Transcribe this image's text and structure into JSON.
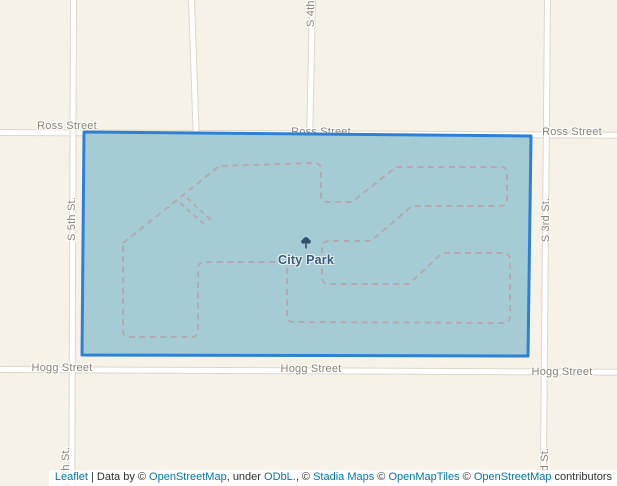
{
  "map": {
    "colors": {
      "land": "#f7f2e7",
      "road_fill": "#ffffff",
      "road_casing": "#dcd6ca",
      "street_label": "#8b8174",
      "park_fill": "#a5ccd4",
      "park_border": "#2e80d4",
      "trail": "#b3a9b0",
      "poi_label": "#3a5a7d",
      "link": "#0078a8"
    },
    "street_labels": {
      "ross_left": "Ross Street",
      "ross_mid": "Ross Street",
      "ross_right": "Ross Street",
      "hogg_left": "Hogg Street",
      "hogg_mid": "Hogg Street",
      "hogg_right": "Hogg Street",
      "s5th": "S 5th St.",
      "s4th": "S 4th St.",
      "s3rd": "S 3rd St.",
      "s5th_bottom": "S 5th St.",
      "s3rd_bottom": "S 3rd St."
    },
    "poi": {
      "name": "City Park",
      "icon": "tree-icon"
    }
  },
  "attribution": {
    "leaflet": "Leaflet",
    "data_by": " | Data by © ",
    "osm1": "OpenStreetMap",
    "under": ", under ",
    "odbl": "ODbL.",
    "c1": ", © ",
    "stadia": "Stadia Maps",
    "c2": " © ",
    "openmaptiles": "OpenMapTiles",
    "c3": " © ",
    "osm2": "OpenStreetMap",
    "contributors": " contributors"
  }
}
